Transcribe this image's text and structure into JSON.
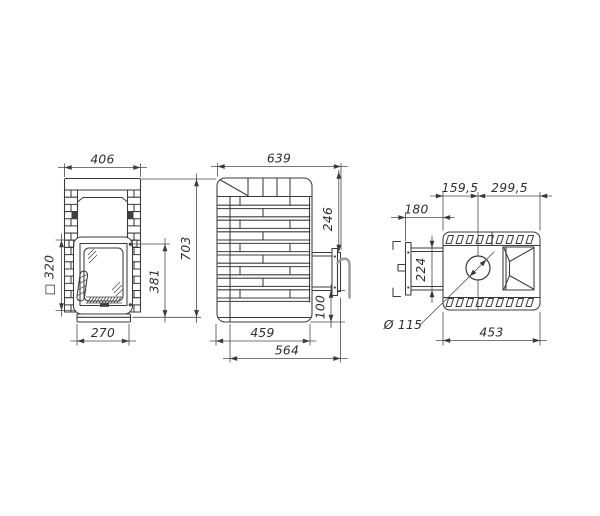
{
  "drawing": {
    "description": "stove three-view dimension drawing",
    "dimensions": {
      "front": {
        "width": "406",
        "opening": "□ 320",
        "door_height": "381",
        "base_width": "270",
        "total_height": "703"
      },
      "side": {
        "depth": "639",
        "flange_top": "246",
        "flange_bottom": "100",
        "body_depth": "459",
        "total_depth": "564"
      },
      "top": {
        "chimney_left": "159,5",
        "chimney_right": "299,5",
        "tunnel_depth": "180",
        "tunnel_width": "224",
        "chimney_diameter": "Ø 115",
        "body_width": "453"
      }
    }
  }
}
